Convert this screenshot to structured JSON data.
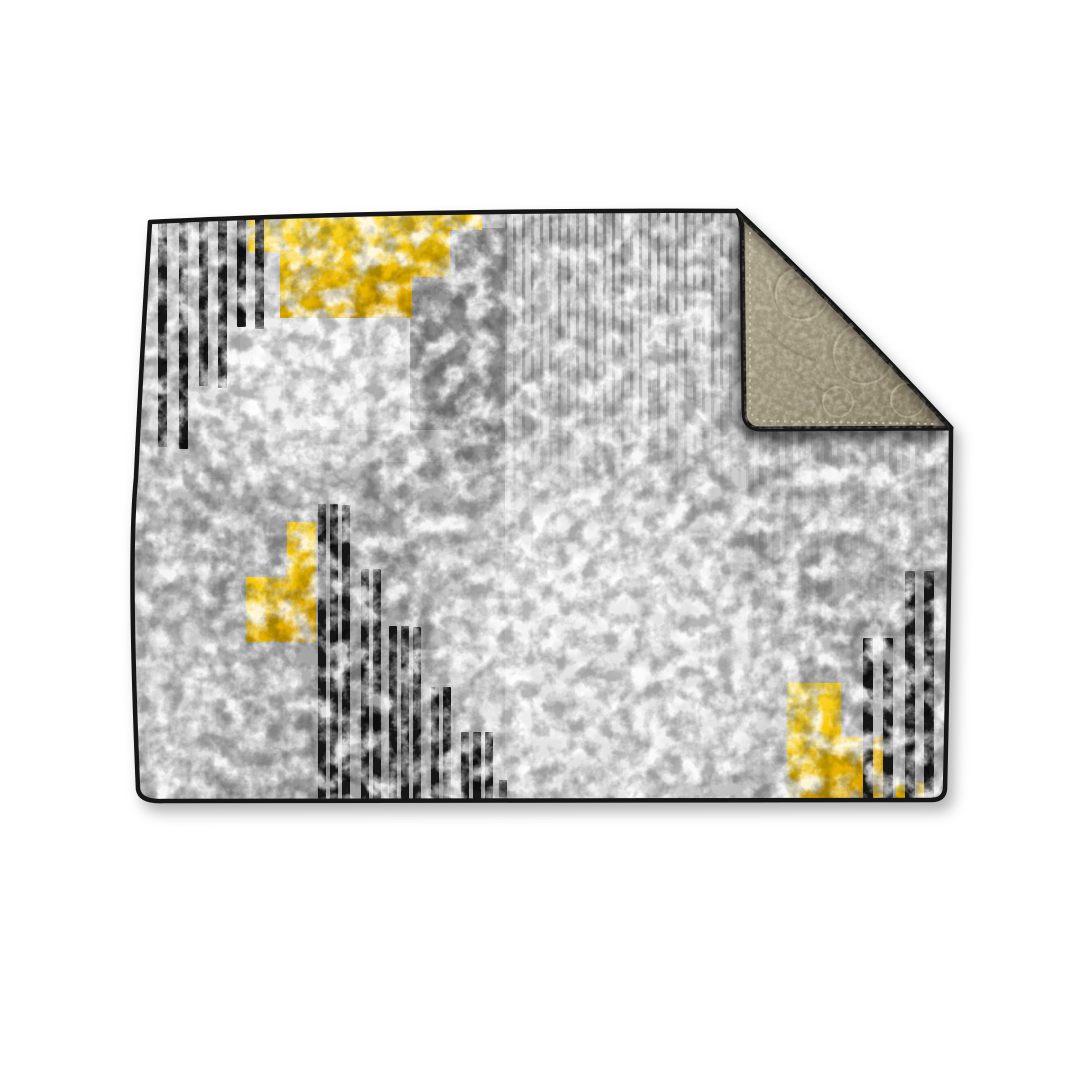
{
  "scene": {
    "type": "product-photo",
    "subject": "reversible abstract area rug with folded corner",
    "background": "#ffffff"
  },
  "colors": {
    "background": "#ffffff",
    "rug_border": "#141414",
    "base_gray": "#bcbcbc",
    "light_gray": "#cfcfcf",
    "lighter_gray": "#e3e3e3",
    "white_patch": "#f4f4f4",
    "dark_gray": "#9a9a9a",
    "darker_gray": "#8d8d8d",
    "pinstripe": "#7d7d7d",
    "light_stripe": "#dcdcdc",
    "stripe_black": "#161616",
    "yellow": "#f5c70a",
    "yellow_light": "#ffdf45",
    "yellow_deep": "#d9a300",
    "backing_base": "#a69d85",
    "backing_mid": "#978e76",
    "backing_dark": "#7f775f",
    "backing_light": "#d3caad",
    "shadow": "#3c3c3c"
  },
  "rug_design": {
    "style": "modern abstract, mottled gray field, black bar clusters, yellow stepped blocks, beige floral backing on folded top-right corner",
    "patches": [
      {
        "x": 140,
        "y": 206,
        "w": 240,
        "h": 340,
        "fill": "light_gray",
        "op": 1
      },
      {
        "x": 240,
        "y": 295,
        "w": 195,
        "h": 245,
        "fill": "lighter_gray",
        "op": 0.85
      },
      {
        "x": 410,
        "y": 228,
        "w": 102,
        "h": 305,
        "fill": "darker_gray",
        "op": 0.9
      },
      {
        "x": 410,
        "y": 440,
        "w": 102,
        "h": 215,
        "fill": "dark_gray",
        "op": 0.6
      },
      {
        "x": 134,
        "y": 430,
        "w": 320,
        "h": 378,
        "fill": "base_gray",
        "op": 0.95
      },
      {
        "x": 205,
        "y": 478,
        "w": 118,
        "h": 330,
        "fill": "dark_gray",
        "op": 0.4
      },
      {
        "x": 216,
        "y": 642,
        "w": 240,
        "h": 166,
        "fill": "dark_gray",
        "op": 0.45
      },
      {
        "x": 317,
        "y": 462,
        "w": 195,
        "h": 345,
        "fill": "dark_gray",
        "op": 0.55
      },
      {
        "x": 505,
        "y": 203,
        "w": 240,
        "h": 335,
        "fill": "light_gray",
        "op": 0.95
      },
      {
        "x": 505,
        "y": 470,
        "w": 26,
        "h": 338,
        "fill": "lighter_gray",
        "op": 0.6
      },
      {
        "x": 742,
        "y": 212,
        "w": 215,
        "h": 222,
        "fill": "dark_gray",
        "op": 0.35
      },
      {
        "x": 744,
        "y": 424,
        "w": 212,
        "h": 205,
        "fill": "base_gray",
        "op": 1
      },
      {
        "x": 748,
        "y": 428,
        "w": 206,
        "h": 255,
        "fill": "dark_gray",
        "op": 0.5
      },
      {
        "x": 744,
        "y": 636,
        "w": 212,
        "h": 172,
        "fill": "base_gray",
        "op": 0.85
      }
    ],
    "highlights": [
      {
        "cx": 615,
        "cy": 665,
        "rx": 180,
        "ry": 135,
        "op": 0.6
      },
      {
        "cx": 535,
        "cy": 555,
        "rx": 120,
        "ry": 95,
        "op": 0.4
      },
      {
        "cx": 300,
        "cy": 390,
        "rx": 100,
        "ry": 95,
        "op": 0.5
      },
      {
        "cx": 640,
        "cy": 330,
        "rx": 75,
        "ry": 100,
        "op": 0.28
      },
      {
        "cx": 195,
        "cy": 705,
        "rx": 95,
        "ry": 80,
        "op": 0.3
      },
      {
        "cx": 850,
        "cy": 500,
        "rx": 90,
        "ry": 60,
        "op": 0.22
      }
    ],
    "top_left_stripes": [
      {
        "x": 158,
        "top": 221,
        "bottom": 447
      },
      {
        "x": 179,
        "top": 221,
        "bottom": 449
      },
      {
        "x": 199,
        "top": 220,
        "bottom": 386
      },
      {
        "x": 218,
        "top": 220,
        "bottom": 388
      },
      {
        "x": 237,
        "top": 219,
        "bottom": 327
      },
      {
        "x": 255,
        "top": 218,
        "bottom": 329
      }
    ],
    "center_stripes": [
      {
        "x": 318,
        "top": 504,
        "bottom": 801
      },
      {
        "x": 330,
        "top": 504,
        "bottom": 801
      },
      {
        "x": 342,
        "top": 505,
        "bottom": 801
      },
      {
        "x": 361,
        "top": 569,
        "bottom": 801
      },
      {
        "x": 373,
        "top": 569,
        "bottom": 801
      },
      {
        "x": 389,
        "top": 626,
        "bottom": 802
      },
      {
        "x": 401,
        "top": 626,
        "bottom": 802
      },
      {
        "x": 413,
        "top": 627,
        "bottom": 802
      },
      {
        "x": 431,
        "top": 687,
        "bottom": 802
      },
      {
        "x": 443,
        "top": 687,
        "bottom": 802
      },
      {
        "x": 461,
        "top": 732,
        "bottom": 803
      },
      {
        "x": 473,
        "top": 732,
        "bottom": 803
      },
      {
        "x": 485,
        "top": 732,
        "bottom": 803
      },
      {
        "x": 499,
        "top": 780,
        "bottom": 803
      }
    ],
    "right_stripes": [
      {
        "x": 863,
        "top": 638,
        "bottom": 799
      },
      {
        "x": 883,
        "top": 638,
        "bottom": 799
      },
      {
        "x": 905,
        "top": 571,
        "bottom": 799
      },
      {
        "x": 924,
        "top": 571,
        "bottom": 799
      }
    ],
    "yellow_blocks": {
      "top": [
        [
          248,
          219
        ],
        [
          482,
          213
        ],
        [
          482,
          230
        ],
        [
          450,
          230
        ],
        [
          450,
          277
        ],
        [
          412,
          277
        ],
        [
          412,
          318
        ],
        [
          280,
          318
        ],
        [
          280,
          252
        ],
        [
          248,
          252
        ]
      ],
      "mid_left": [
        [
          287,
          522
        ],
        [
          316,
          522
        ],
        [
          316,
          642
        ],
        [
          246,
          642
        ],
        [
          246,
          577
        ],
        [
          287,
          577
        ]
      ],
      "bottom_right": [
        [
          787,
          683
        ],
        [
          841,
          683
        ],
        [
          841,
          737
        ],
        [
          883,
          737
        ],
        [
          883,
          800
        ],
        [
          787,
          800
        ]
      ],
      "small_squares": [
        {
          "x": 896,
          "y": 783,
          "w": 10,
          "h": 17
        },
        {
          "x": 917,
          "y": 783,
          "w": 9,
          "h": 17
        }
      ]
    }
  }
}
